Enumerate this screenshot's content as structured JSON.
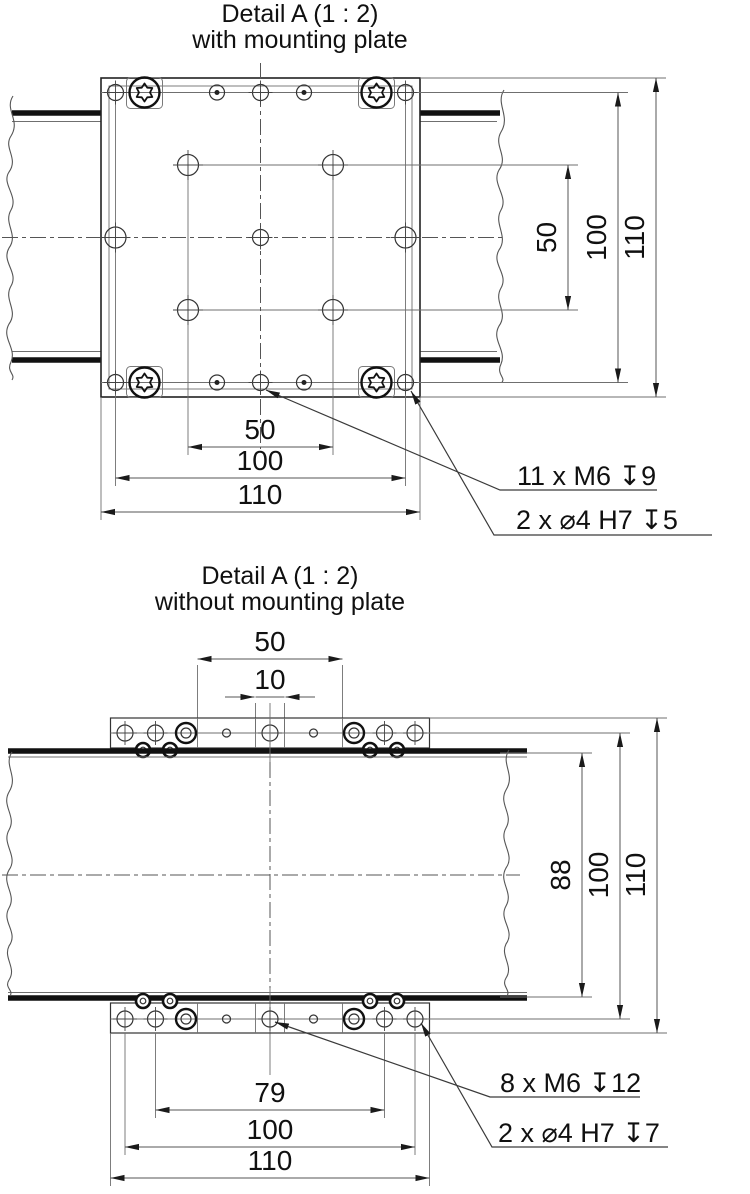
{
  "detail_with_plate": {
    "title": "Detail A (1 : 2)",
    "subtitle": "with mounting plate",
    "dims_right": [
      "50",
      "100",
      "110"
    ],
    "dims_bottom": [
      "50",
      "100",
      "110"
    ],
    "callout_thread": "11 x M6 ↧9",
    "callout_fit": "2 x ⌀4 H7 ↧5"
  },
  "detail_without_plate": {
    "title": "Detail A (1 : 2)",
    "subtitle": "without mounting plate",
    "dims_top": [
      "50",
      "10"
    ],
    "dims_right": [
      "88",
      "100",
      "110"
    ],
    "dims_bottom": [
      "79",
      "100",
      "110"
    ],
    "callout_thread": "8 x M6 ↧12",
    "callout_fit": "2 x ⌀4 H7 ↧7"
  }
}
